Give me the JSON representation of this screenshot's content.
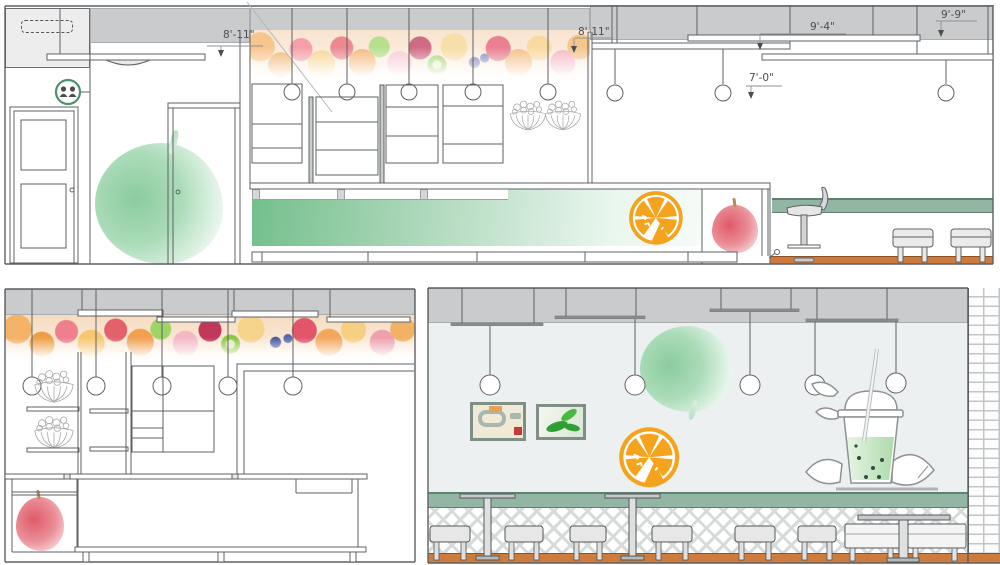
{
  "drawing": {
    "type": "juice-bar-interior-elevations",
    "dimensions": {
      "soffit_left": "8'-11\"",
      "soffit_mid": "8'-11\"",
      "ceiling_mid": "9'-4\"",
      "ceiling_right": "9'-9\"",
      "pendant_drop": "7'-0\""
    },
    "palette": {
      "ceiling_gray": "#c9cbcc",
      "wall_gray": "#edf0f1",
      "counter_green_dark": "#74bf8c",
      "counter_green_light": "#f7fbf8",
      "sage_band": "#93b5a4",
      "floor_orange": "#cd7c3d",
      "accent_orange": "#f5a31c",
      "apple_red": "#df5a68",
      "apple_green": "#8ccb9e",
      "line_gray": "#5d6165",
      "lattice_gray": "#d6dada",
      "restroom_ring_green": "#4e8f6e"
    },
    "graphics": [
      "restroom-sign",
      "pendant-lamp",
      "fruit-mural",
      "fruit-basket",
      "green-apple",
      "red-apple",
      "orange-slice",
      "smoothie-cup",
      "abstract-painting",
      "leaf-painting",
      "bar-stool",
      "dining-stool",
      "pedestal-table",
      "bench-seat",
      "brick-pilaster",
      "lattice-wainscot",
      "suspended-ceiling-panel"
    ]
  }
}
